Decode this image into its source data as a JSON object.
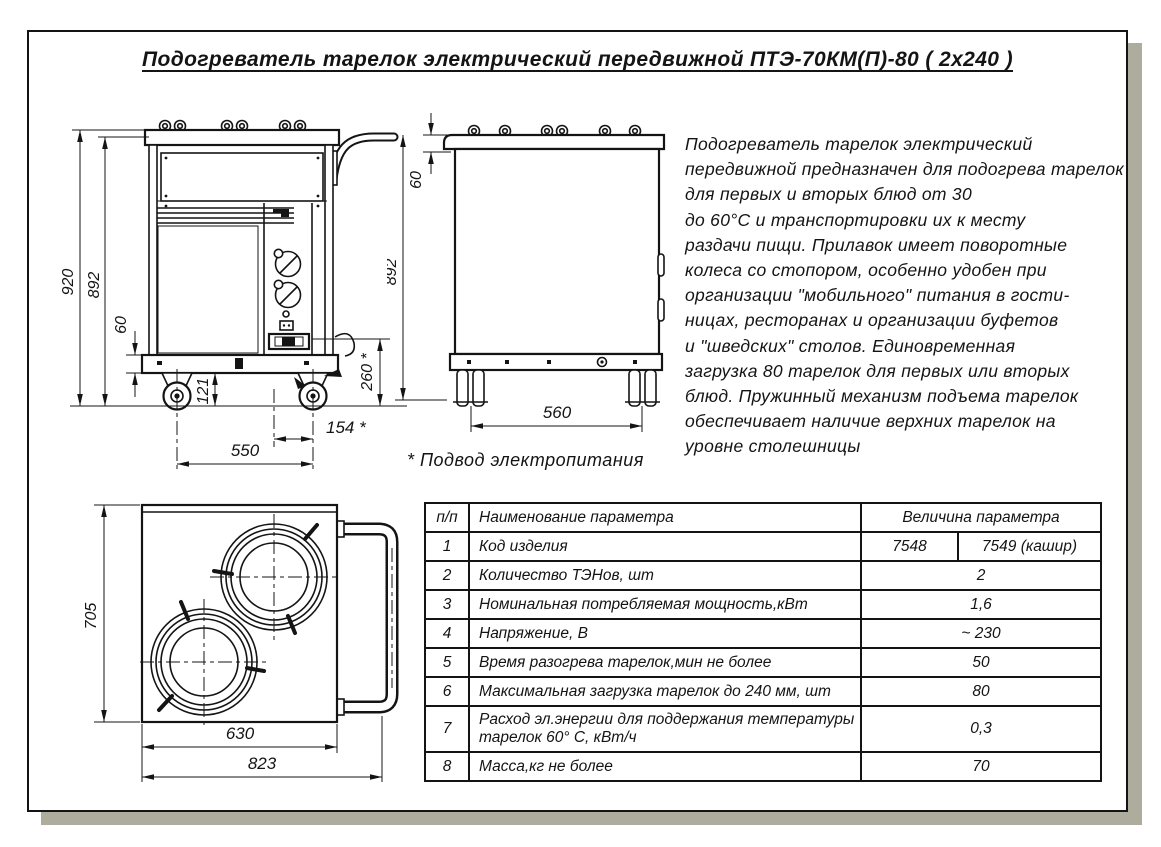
{
  "title": "Подогреватель тарелок электрический передвижной  ПТЭ-70КМ(П)-80 ( 2х240 )",
  "description": {
    "lines": [
      "Подогреватель тарелок электрический",
      "передвижной предназначен для подогрева тарелок",
      "для первых и вторых блюд от 30",
      "до 60°С и транспортировки их к месту",
      "раздачи пищи. Прилавок имеет поворотные",
      "колеса со стопором, особенно удобен при",
      "организации \"мобильного\" питания в гости-",
      "ницах, ресторанах и организации буфетов",
      "и \"шведских\" столов. Единовременная",
      "загрузка 80 тарелок для первых или вторых",
      "блюд. Пружинный механизм подъема тарелок",
      "обеспечивает наличие верхних тарелок на",
      "уровне столешницы"
    ]
  },
  "note": "* Подвод электропитания",
  "drawings": {
    "front_view": {
      "dims": {
        "height_overall": "920",
        "height_body": "892",
        "base_height": "60",
        "wheel_clearance": "121",
        "wheel_base": "550",
        "cable_offset": "154 *",
        "cable_height": "260 *"
      }
    },
    "side_view": {
      "dims": {
        "top_height": "60",
        "height_body": "892",
        "wheel_base": "560"
      }
    },
    "top_view": {
      "dims": {
        "depth": "705",
        "body_width": "630",
        "overall_width": "823"
      }
    }
  },
  "table": {
    "headers": {
      "num": "п/п",
      "name": "Наименование параметра",
      "value": "Величина параметра"
    },
    "rows": [
      {
        "num": "1",
        "name": "Код изделия",
        "value": "7548",
        "value2": "7549 (кашир)"
      },
      {
        "num": "2",
        "name": "Количество ТЭНов, шт",
        "value": "2"
      },
      {
        "num": "3",
        "name": "Номинальная потребляемая мощность,кВт",
        "value": "1,6"
      },
      {
        "num": "4",
        "name": "Напряжение, В",
        "value": "~ 230"
      },
      {
        "num": "5",
        "name": "Время разогрева тарелок,мин не более",
        "value": "50"
      },
      {
        "num": "6",
        "name": "Максимальная загрузка тарелок до 240 мм, шт",
        "value": "80"
      },
      {
        "num": "7",
        "name": "Расход эл.энергии для поддержания температуры тарелок 60° С, кВт/ч",
        "value": "0,3"
      },
      {
        "num": "8",
        "name": "Масса,кг не более",
        "value": "70"
      }
    ]
  },
  "colors": {
    "line": "#141414",
    "shadow": "#aeac9c",
    "paper": "#ffffff"
  }
}
